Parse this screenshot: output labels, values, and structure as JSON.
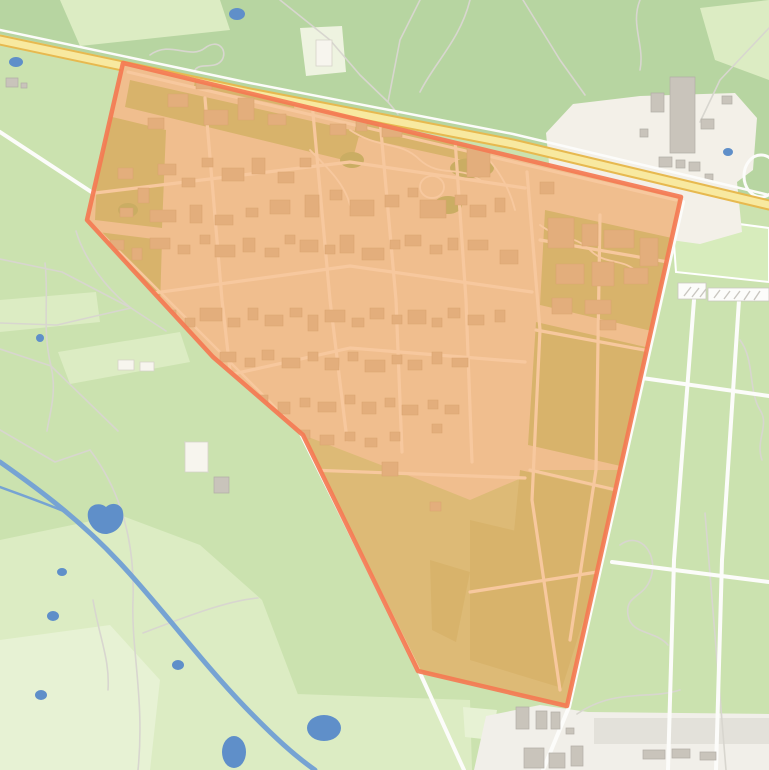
{
  "meta": {
    "kind": "topographic-map",
    "highlight": "selected area polygon over a campus/estate between a motorway and farmland"
  },
  "colors": {
    "land": "#cbe2af",
    "forest": "#b7d5a1",
    "field_pale": "#dcecc3",
    "field_paler": "#e7f2d4",
    "clearing": "#eef3e0",
    "sports": "#d7ecbc",
    "farm_bg": "#f3f0e8",
    "industrial_bg": "#f1efe9",
    "industrial_pad": "#e3e1da",
    "gray_building": "#c9c4bb",
    "white_structure": "#f7f5ee",
    "road": "#fcfcfa",
    "trail": "#d8d6cf",
    "water": "#76a3d3",
    "water_fill": "#5f8fc9",
    "highway_core": "#f8e9a0",
    "highway_casing": "#e7b94f",
    "campus_base": "#eee9dd",
    "campus_field": "#c3d49c",
    "campus_tree": "#a9c98c",
    "campus_building": "#d7cbbb",
    "overlay_fill": "#f28c33",
    "overlay_stroke": "#f47a52"
  },
  "overlay": {
    "polygon_points": "123,63 681,197 567,706 418,671 303,435 213,357 87,220",
    "fill_opacity": 0.46
  },
  "geometry": {
    "forest_d": "M0 0H769V201L513 140 250 88 0 34Z",
    "pale_d": "M0 540L120 515 200 545 262 600 300 700 282 770 0 770Z M0 300L96 292 100 322 0 332Z M58 352L180 332 190 362 70 384Z M60 0L220 0 230 30 80 46Z M180 690L470 700 472 770 180 770Z M700 8L769 0 769 80 715 60Z",
    "pale2_d": "M0 640L110 625 160 680 150 770 0 770Z M463 707L497 710 492 740 465 737Z",
    "clearing_d": "M300 28L342 26 346 72 306 76Z",
    "sports_d": "M672 215L769 228 769 282 676 272Z",
    "farm_area_d": "M546 133L573 104 640 96 735 93 757 118 753 170 737 182 742 232 700 244 656 238 636 250 584 250 557 243Z",
    "industrial_area_d": "M474 770L486 716 540 705 588 712 769 714 769 770Z",
    "industrial_pad_d": "M594 718H769V744H594Z",
    "river_d": "M0 462C40 490 80 520 120 563 160 606 200 660 245 707 275 738 295 756 315 770",
    "tributary_d": "M0 487C30 498 50 505 68 513",
    "ponds_d": "M9 62a7 5 0 1 0 14 0a7 5 0 1 0 -14 0Z M229 14a8 6 0 1 0 16 0a8 6 0 1 0 -16 0Z M723 152a5 4 0 1 0 10 0a5 4 0 1 0 -10 0Z M88 512c2 -8 12 -10 18 -5 6 -6 16 -3 17 5 2 10 -4 20 -16 22 -12 1 -21 -12 -19 -22Z M57 572a5 4 0 1 0 10 0a5 4 0 1 0 -10 0Z M47 616a6 5 0 1 0 12 0a6 5 0 1 0 -12 0Z M35 695a6 5 0 1 0 12 0a6 5 0 1 0 -12 0Z M172 665a6 5 0 1 0 12 0a6 5 0 1 0 -12 0Z M222 752a12 16 0 1 0 24 0a12 16 0 1 0 -24 0Z M307 728a17 13 0 1 0 34 0a17 13 0 1 0 -34 0Z M36 338a4 4 0 1 0 8 0a4 4 0 1 0 -8 0Z",
    "roads_d": "M0 132L230 283 303 438 420 673 464 770 M683 202L569 707 543 770 M694 300L674 560 668 770 M739 300L722 560 716 770 M642 378L769 396 M612 562L769 582",
    "trails_d": "M150 55C170 40 190 60 205 48 218 38 228 50 222 60 215 70 200 62 195 70 M280 0L330 40 360 75 388 102 M420 0L400 40 388 102 M470 0C460 40 435 62 420 92 M388 102L398 114 M523 0L560 60 585 95 M640 0C630 25 645 45 640 70 M769 28L720 80 700 122 M0 259L62 272 131 308 166 331 M0 323L57 325 100 315 131 308 M76 231C84 258 105 288 131 308 M45 263C49 298 42 330 51 366 M51 366C57 392 50 412 47 431 M0 349L51 366 M51 366L118 431 M90 450C120 490 135 540 133 600 M133 600C131 650 145 700 138 770 M0 430L55 462 90 450 M143 633C190 615 230 600 258 598 M93 600C100 640 110 660 108 690 M208 472C190 470 187 455 185 442 M705 513L726 770 M620 545C640 530 660 555 650 580 643 598 625 595 628 615 631 635 655 630 668 645 M740 340C755 360 748 390 760 410 770 425 755 440 762 460 M577 714C615 688 648 700 680 690",
    "gray_buildings_d": "M670 77h25v76h-25z M651 93h13v19h-13z M701 119h13v10h-13z M722 96h10v8h-10z M659 157h13v10h-13z M676 160h9v8h-9z M689 162h11v9h-11z M640 129h8v8h-8z M705 174h8v6h-8z M6 78h12v9h-12z M21 83h6v5h-6z M214 477h15v16h-15z M516 707h13v22h-13z M536 711h11v18h-11z M551 712h9v17h-9z M524 748h20v20h-20z M549 753h16v15h-16z M571 746h12v20h-12z M566 728h8v6h-8z M643 750h22v9h-22z M672 749h18v9h-18z M700 752h16v8h-16z",
    "white_structures_d": "M316 40h16v26h-16z M185 442h23v30h-23z M118 360h16v10h-16z M140 362h14v9h-14z",
    "stripes_d": "M678 283h28v16h-28z M708 288h61v13h-61z",
    "stripes_hatch_d": "M684 296l7 -9M692 297l7 -9M700 297l6 -8M714 298l6 -8M724 299l6 -8M734 299l6 -8M744 300l6 -9M754 300l6 -9",
    "track_d": "M744 176a17 21 0 1 0 34 0a17 21 0 1 0 -34 0Z",
    "highway_d": "M0 40L250 93 513 144 769 205",
    "frontage_d": "M0 30L250 83 513 134 769 195",
    "campus_base_d": "M87 55L681 197 655 350 628 470 540 470 470 500 420 480 303 435 213 357 87 220Z",
    "campus_fields_d": "M95 220L162 228 166 130 100 114Z M96 300L160 308 162 240 98 232Z M130 80L360 132 352 162 125 107Z M360 96L480 122 472 162 354 136Z M545 210L672 238 656 332 540 305Z M536 322L650 348 638 470 528 445Z M520 470L616 492 600 600 560 640 505 625Z M470 520L605 552 562 688 470 660Z M430 560L470 572 456 642 432 630Z M198 62L298 84 294 108 194 86Z",
    "campus_trees_d": "M340 160a12 8 0 1 0 24 0a12 8 0 1 0 -24 0Z M450 168a22 10 0 1 0 44 0a22 10 0 1 0 -44 0Z M434 205a14 9 0 1 0 28 0a14 9 0 1 0 -28 0Z M118 210a10 7 0 1 0 20 0a10 7 0 1 0 -20 0Z",
    "campus_paths_d": "M350 130C380 150 400 140 420 160 440 178 460 165 480 180M420 187a12 11 0 1 0 24 0a12 11 0 1 0 -24 0M310 150C330 170 345 185 350 205M480 150C500 170 510 190 515 210M540 225C560 240 575 235 590 250 605 265 620 258 635 270",
    "campus_service_d": "M128 72L676 200",
    "campus_edge_d": "M90 222L300 432 418 668",
    "campus_roads_d": "M95 193L350 162 525 188 M103 300L350 266 532 292 M170 388L350 348 525 362 M310 470L525 478 M205 98L222 300 232 388 M310 80L330 300 347 440 M380 120L396 300 402 452 M452 95L466 300 472 462 M527 172L540 330 532 500 560 690 M600 215L596 470 570 640 M540 240L668 262 M536 330L655 352 M530 470L625 492 M470 592L610 570",
    "campus_buildings_d": "M148 118h16v11h-16z M168 94h20v13h-20z M196 78h16v11h-16z M222 70h14v10h-14z M204 110h24v15h-24z M238 98h16v22h-16z M262 88h12v9h-12z M282 76h13v11h-13z M300 90h16v13h-16z M268 114h18v11h-18z M318 70h22v14h-22z M344 92h14v9h-14z M362 78h11v9h-11z M388 86h24v16h-24z M416 96h12v9h-12z M330 124h16v11h-16z M356 118h11v13h-11z M382 128h20v9h-20z M467 140h23v37h-23z M440 104h12v10h-12z M118 168h15v11h-15z M138 188h11v15h-11z M158 164h18v11h-18z M182 178h13v9h-13z M202 158h11v9h-11z M222 168h22v13h-22z M252 158h13v16h-13z M278 172h16v11h-16z M300 158h11v9h-11z M120 208h13v9h-13z M150 210h26v12h-26z M190 205h12v18h-12z M215 215h18v10h-18z M246 208h12v9h-12z M270 200h20v14h-20z M305 195h14v22h-14z M330 190h12v10h-12z M350 200h24v16h-24z M385 195h14v12h-14z M408 188h10v9h-10z M420 200h26v18h-26z M455 195h12v10h-12z M470 205h16v12h-16z M495 198h10v14h-10z M110 240h14v10h-14z M132 248h10v12h-10z M150 238h20v11h-20z M178 245h12v9h-12z M200 235h10v9h-10z M215 245h20v12h-20z M243 238h12v14h-12z M265 248h14v9h-14z M285 235h10v9h-10z M300 240h18v12h-18z M325 245h10v9h-10z M340 235h14v18h-14z M362 248h22v12h-22z M390 240h10v9h-10z M405 235h16v11h-16z M430 245h12v9h-12z M448 238h10v12h-10z M468 240h20v10h-20z M500 250h18v14h-18z M115 312h18v12h-18z M140 320h12v16h-12z M162 310h14v10h-14z M185 318h10v9h-10z M200 308h22v13h-22z M228 318h12v9h-12z M248 308h10v12h-10z M265 315h18v11h-18z M290 308h12v9h-12z M308 315h10v16h-10z M325 310h20v12h-20z M352 318h12v9h-12z M370 308h14v11h-14z M392 315h10v9h-10z M408 310h18v14h-18z M432 318h10v9h-10z M448 308h12v10h-12z M468 315h16v10h-16z M495 310h10v12h-10z M175 355h14v10h-14z M200 360h10v12h-10z M220 352h16v10h-16z M245 358h10v9h-10z M262 350h12v10h-12z M282 358h18v10h-18z M308 352h10v9h-10z M325 358h14v12h-14z M348 352h10v9h-10z M365 360h20v12h-20z M392 355h10v9h-10z M408 360h14v10h-14z M432 352h10v12h-10z M452 358h16v9h-16z M210 398h12v9h-12z M235 402h16v10h-16z M258 395h10v9h-10z M278 402h12v12h-12z M300 398h10v9h-10z M318 402h18v10h-18z M345 395h10v9h-10z M362 402h14v12h-14z M385 398h10v9h-10z M402 405h16v10h-16z M428 400h10v9h-10z M445 405h14v9h-14z M300 430h10v9h-10z M320 435h14v10h-14z M345 432h10v9h-10z M365 438h12v9h-12z M390 432h10v9h-10z M432 424h10v9h-10z M540 182h14v12h-14z M548 218h26v30h-26z M582 224h16v22h-16z M604 230h30v18h-30z M640 238h18v28h-18z M556 264h28v20h-28z M592 262h22v24h-22z M624 268h24v16h-24z M585 300h26v14h-26z M552 298h20v16h-20z M600 320h16v10h-16z M382 462h16v14h-16z M430 502h11v9h-11z"
  }
}
